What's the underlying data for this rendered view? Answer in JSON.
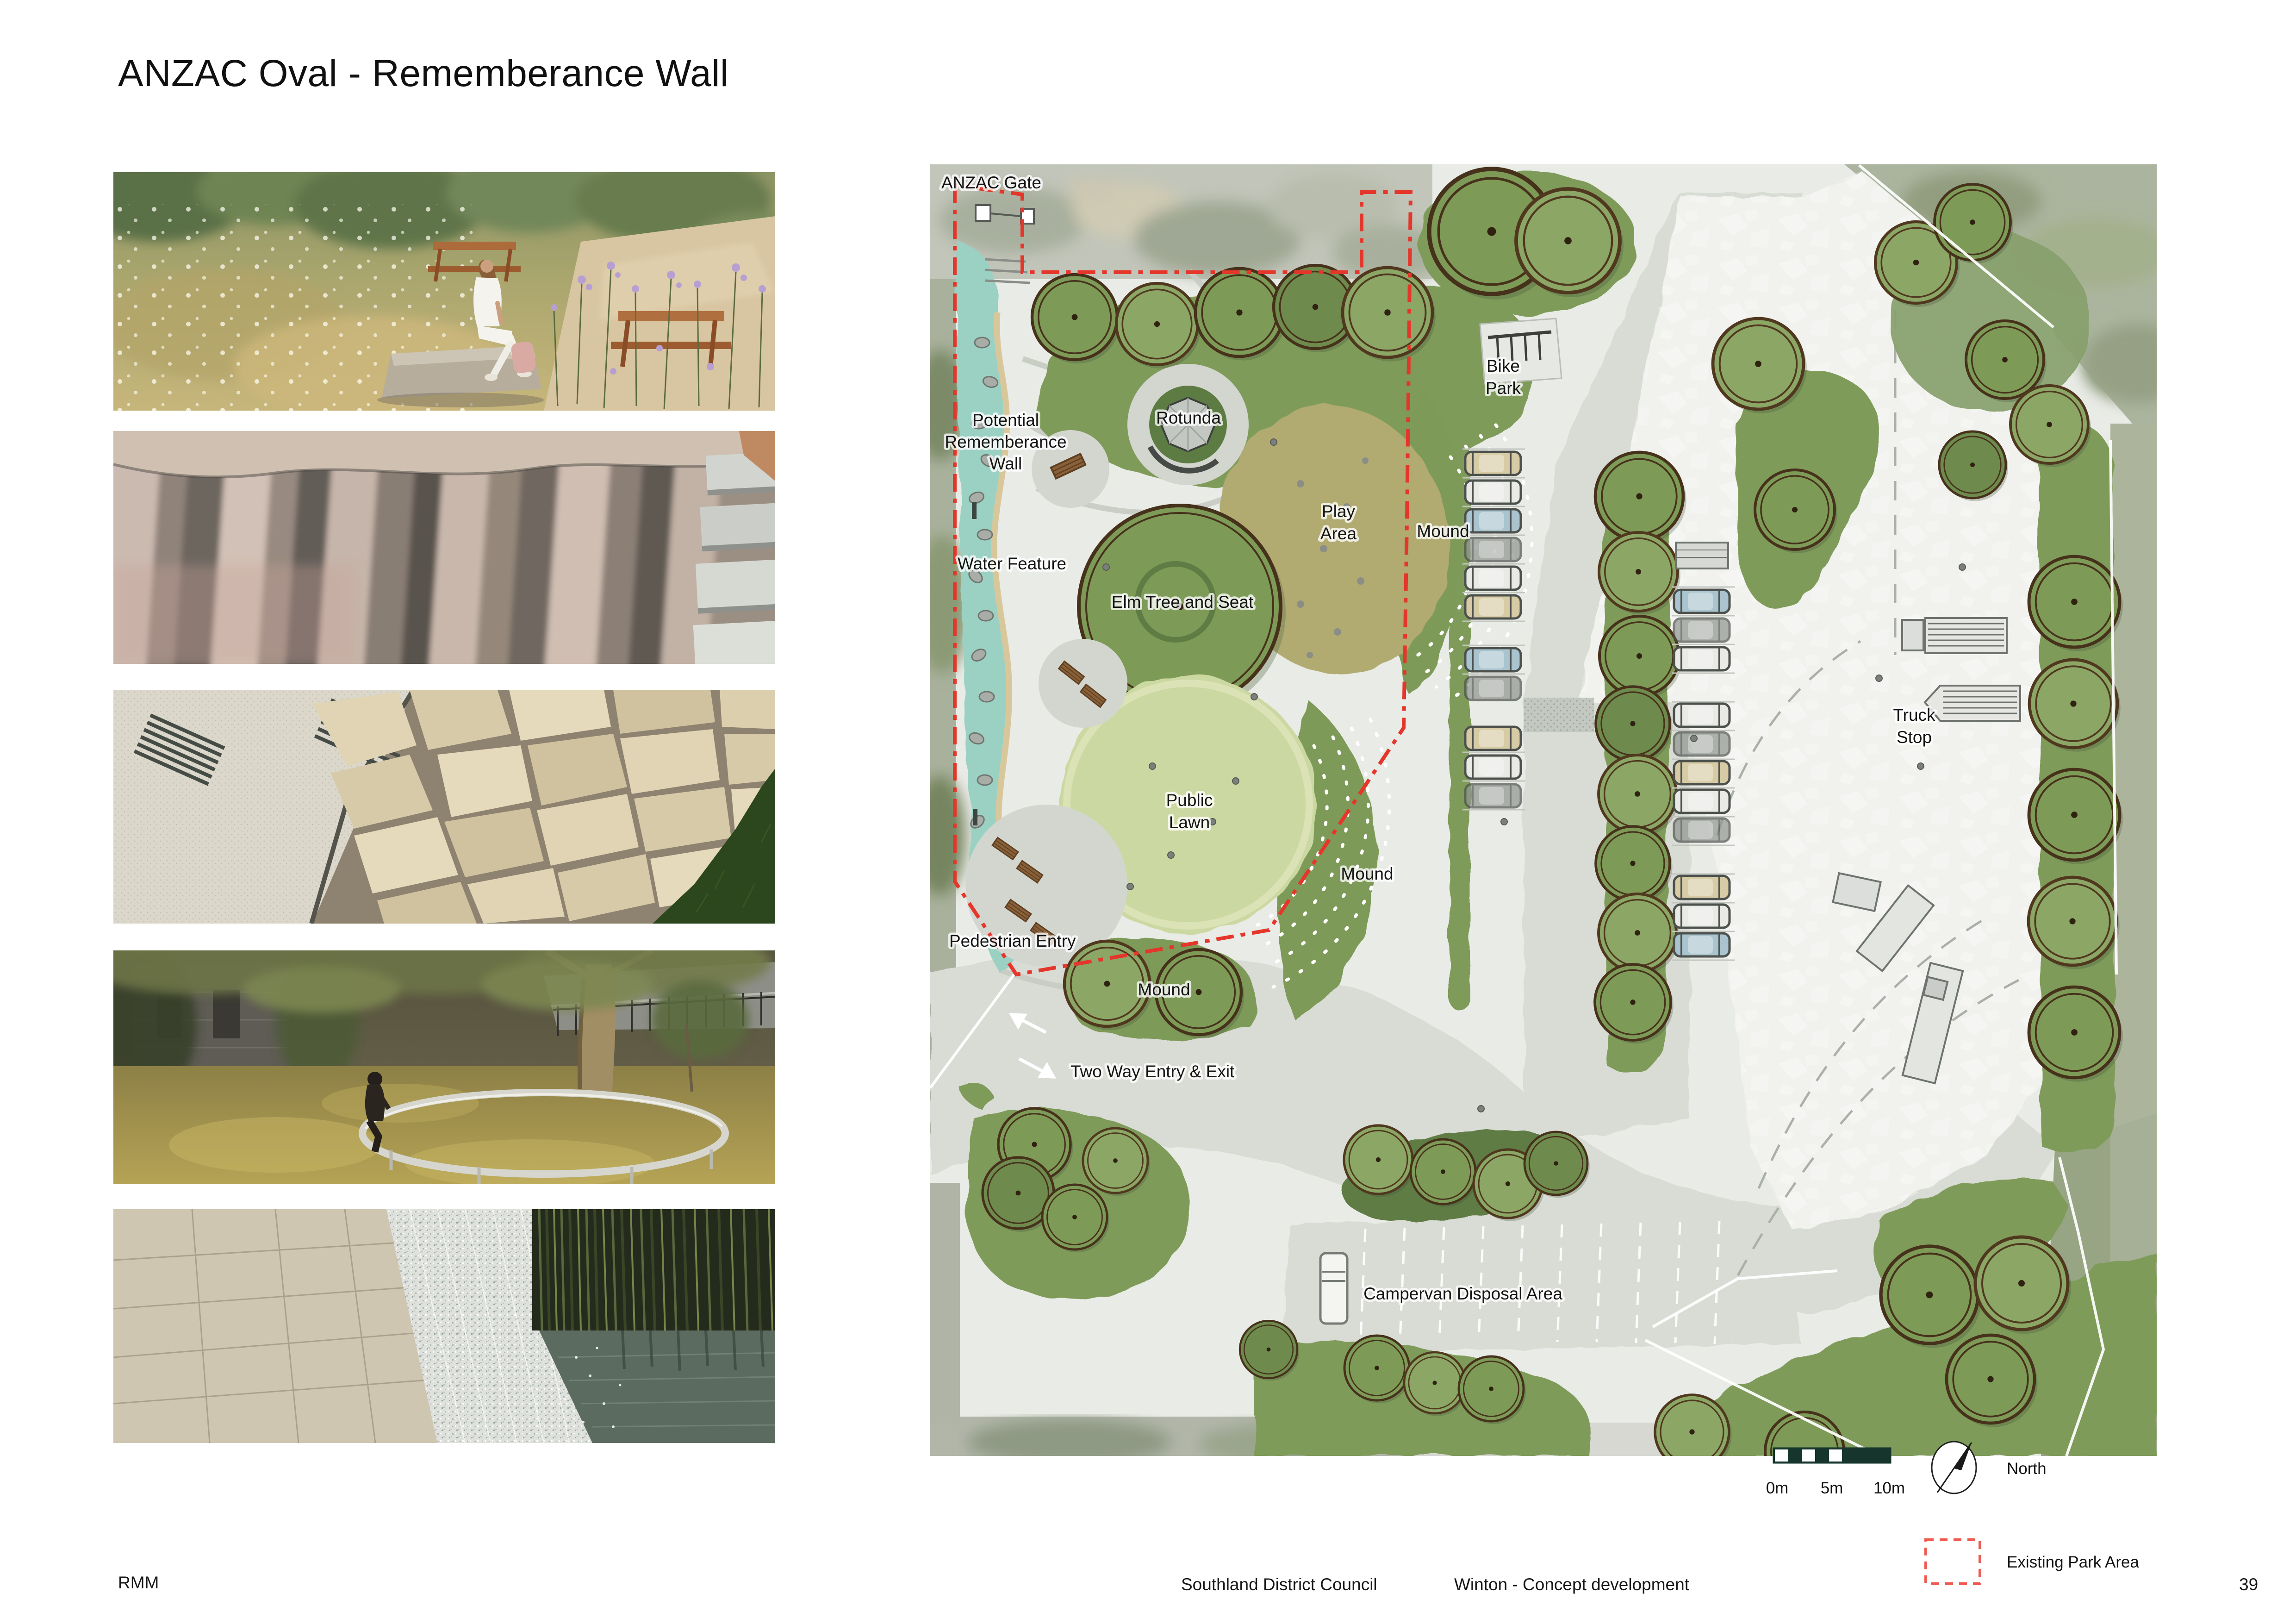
{
  "page": {
    "title": "ANZAC Oval - Rememberance Wall"
  },
  "photos": [
    {
      "name": "photo-wildflower-meadow-seating",
      "alt": "person seated on stone block in wildflower meadow beside gravel path with picnic tables"
    },
    {
      "name": "photo-carved-stone-wall",
      "alt": "close up of textured pink and grey carved stone monolith beside concrete steps"
    },
    {
      "name": "photo-crazy-paving",
      "alt": "cream flagstone crazy paving with metal benches and grass edge"
    },
    {
      "name": "photo-circular-tree-seat",
      "alt": "circular stainless steel ring bench around large tree at dusk"
    },
    {
      "name": "photo-water-wall",
      "alt": "sheet of water cascading from stone wall into pond with bamboo behind"
    }
  ],
  "plan": {
    "labels": {
      "anzac_gate": "ANZAC Gate",
      "bike_park_1": "Bike",
      "bike_park_2": "Park",
      "wall_1": "Potential",
      "wall_2": "Rememberance",
      "wall_3": "Wall",
      "rotunda": "Rotunda",
      "water_feature": "Water Feature",
      "play_1": "Play",
      "play_2": "Area",
      "mound_ne": "Mound",
      "elm": "Elm Tree and Seat",
      "lawn_1": "Public",
      "lawn_2": "Lawn",
      "truck_1": "Truck",
      "truck_2": "Stop",
      "mound_mid": "Mound",
      "ped_entry": "Pedestrian Entry",
      "mound_s": "Mound",
      "two_way": "Two Way Entry & Exit",
      "campervan": "Campervan Disposal Area"
    },
    "colors": {
      "boundary_red": "#e5362b",
      "tree_green": "#7d9a57",
      "lawn_green": "#ccd8a1",
      "play_khaki": "#b1ab71",
      "water_teal": "#9bd1c3"
    }
  },
  "legend": {
    "scale_0": "0m",
    "scale_5": "5m",
    "scale_10": "10m",
    "north": "North",
    "existing_park": "Existing Park Area"
  },
  "footer": {
    "logo": "RMM",
    "client": "Southland District Council",
    "project": "Winton - Concept development",
    "page_number": "39"
  }
}
